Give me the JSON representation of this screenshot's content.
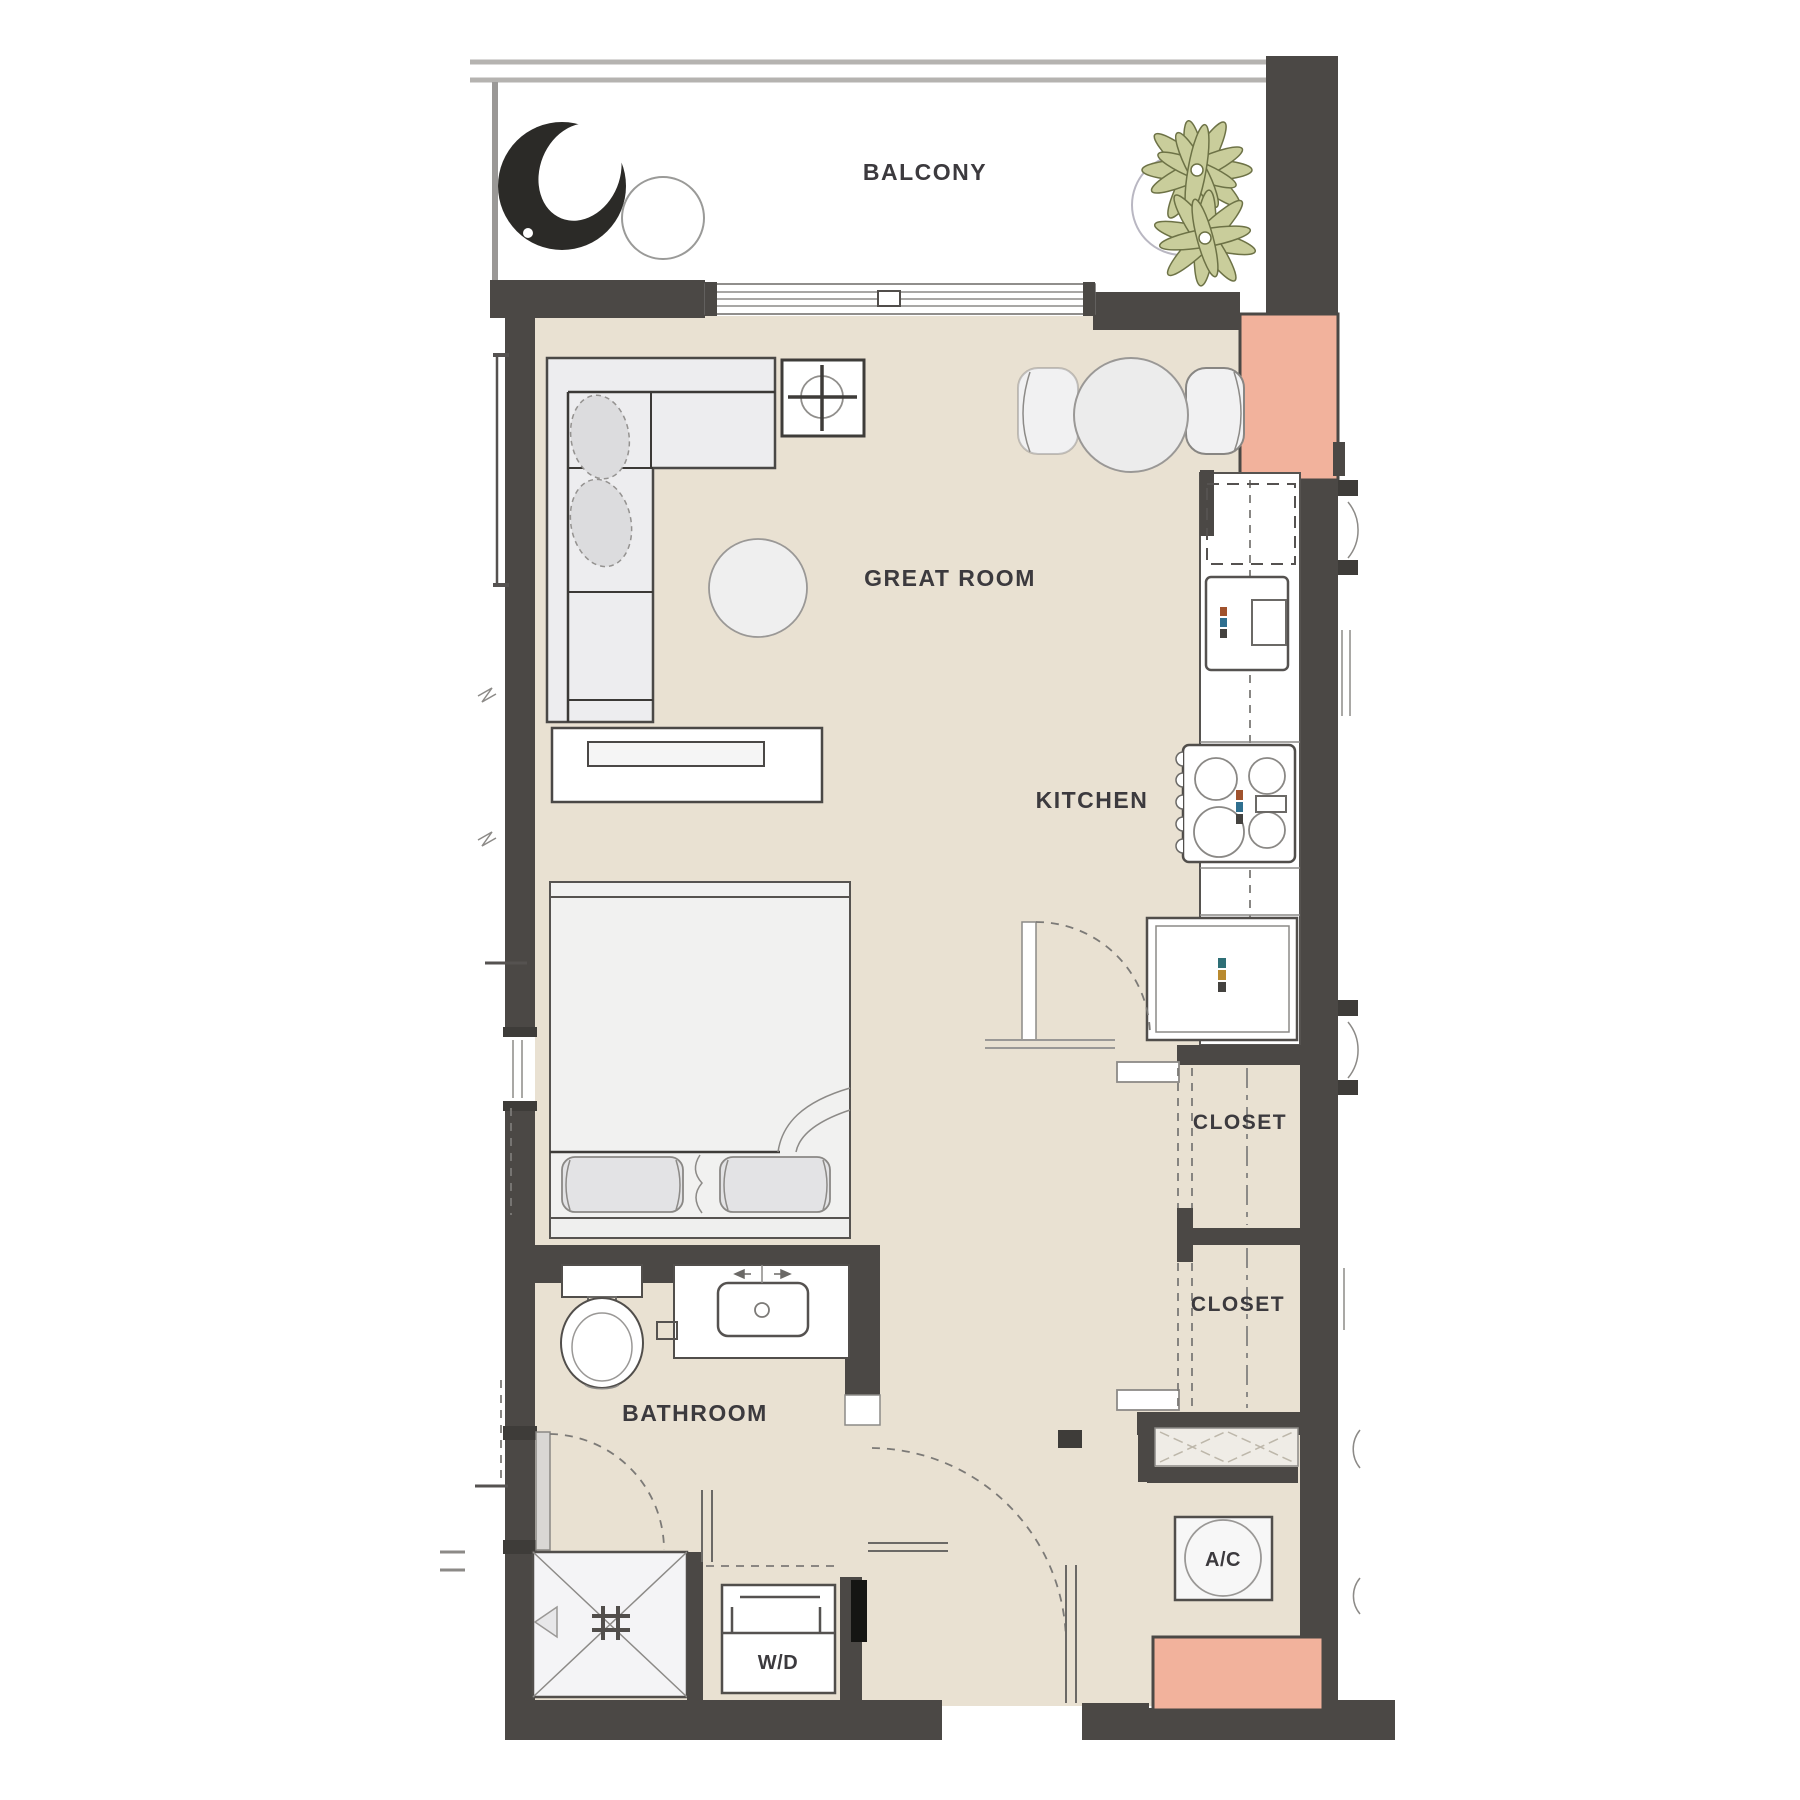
{
  "plan": {
    "type": "apartment-floor-plan",
    "labels": {
      "balcony": "BALCONY",
      "great_room": "GREAT ROOM",
      "kitchen": "KITCHEN",
      "closet_upper": "CLOSET",
      "closet_lower": "CLOSET",
      "bathroom": "BATHROOM",
      "washer_dryer": "W/D",
      "ac": "A/C"
    },
    "colors": {
      "wall": "#4B4845",
      "floor_interior": "#E9E1D2",
      "accent_pink": "#F2B29C",
      "fixture_fill": "#F1F1F2",
      "label_text": "#3C3A3E",
      "plant_leaf": "#C9CD9B",
      "balcony_floor": "#FFFFFF"
    },
    "fixtures": [
      "egg-chair",
      "balcony-side-table",
      "potted-plant",
      "balcony-railing",
      "sliding-glass-door",
      "sectional-sofa",
      "throw-pillows",
      "end-table-with-plant",
      "round-ottoman",
      "media-console",
      "dining-table",
      "dining-chairs",
      "kitchen-counter",
      "upper-cabinet-dashed",
      "wall-oven",
      "range-4-burner",
      "refrigerator",
      "bed-with-pillows",
      "toilet",
      "vanity-sink",
      "towel-ring",
      "shower-stall",
      "washer-dryer-unit",
      "ac-unit",
      "closet-rods",
      "entry-shelf",
      "door-swing-arcs",
      "structural-columns-pink",
      "window-marks"
    ]
  }
}
